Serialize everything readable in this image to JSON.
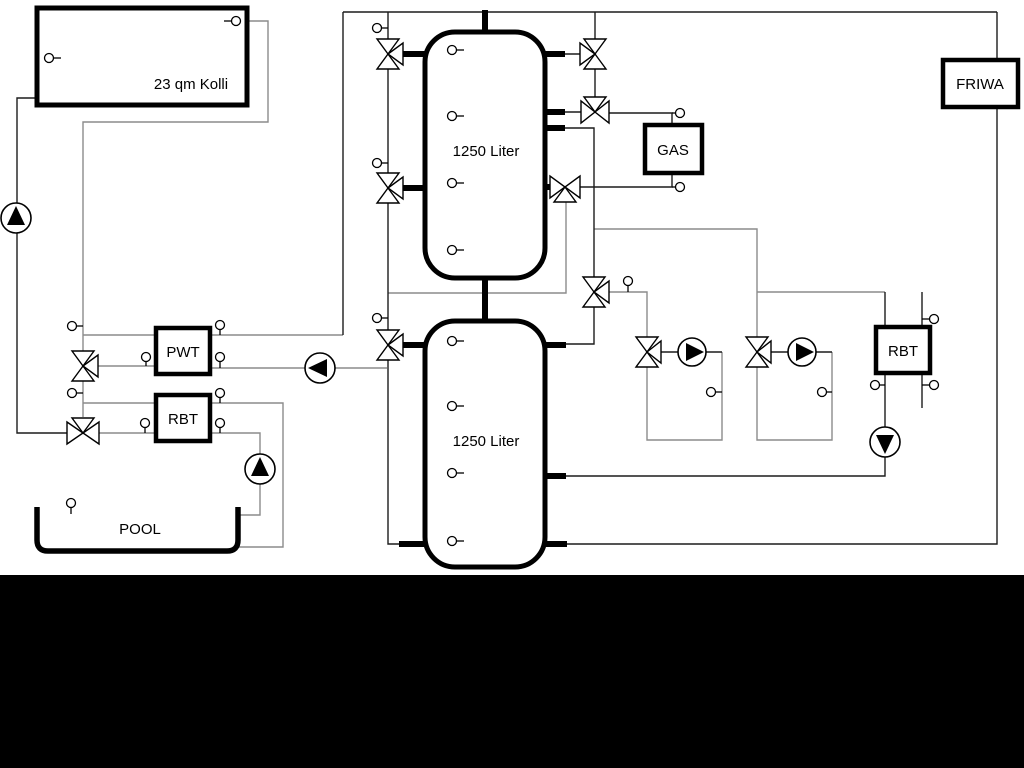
{
  "diagram": {
    "labels": {
      "collector": "23 qm Kolli",
      "buffer_tank_top": "1250 Liter",
      "buffer_tank_bottom": "1250 Liter",
      "gas_boiler": "GAS",
      "friwa": "FRIWA",
      "pwt": "PWT",
      "rbt_pool": "RBT",
      "rbt_right": "RBT",
      "pool": "POOL"
    },
    "colors": {
      "background": "#ffffff",
      "line_dark": "#1c1c1c",
      "line_gray": "#8c8c8c",
      "component_outline": "#000000",
      "bottom_bar": "#000000"
    }
  }
}
